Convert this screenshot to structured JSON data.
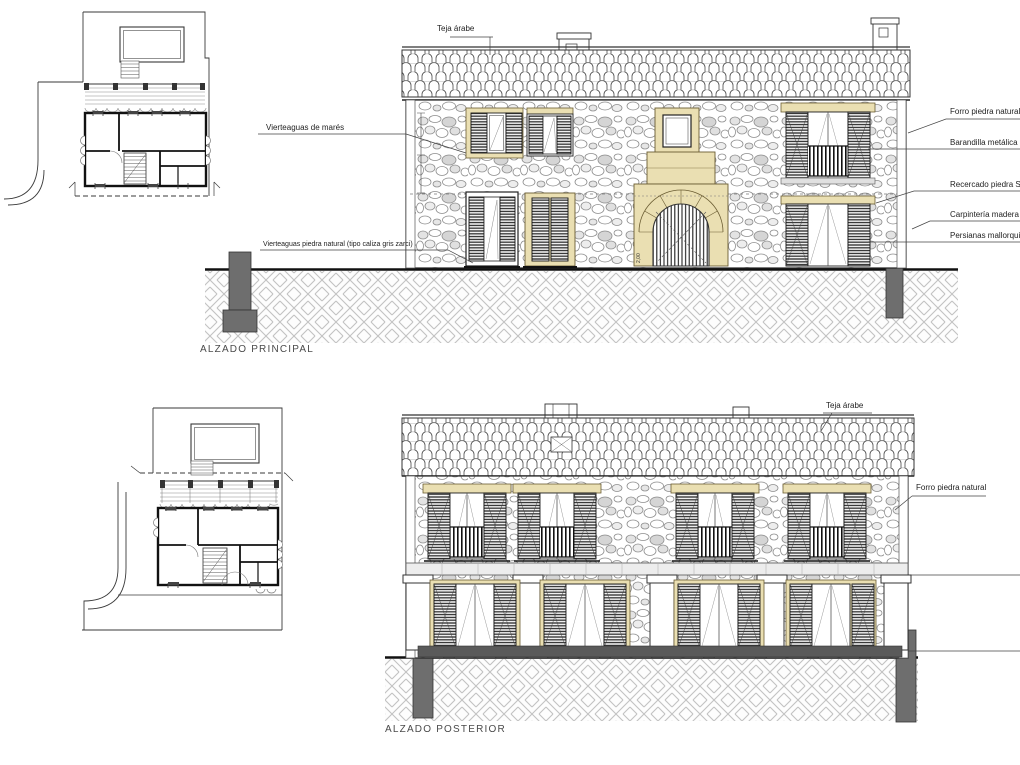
{
  "sheet": {
    "principal": {
      "title": "ALZADO PRINCIPAL",
      "labels": {
        "teja_arabe": "Teja árabe",
        "vierteaguas_mares": "Vierteaguas de marés",
        "vierteaguas_piedra": "Vierteaguas piedra natural (tipo caliza gris zarci)",
        "forro_piedra": "Forro piedra natural",
        "barandilla": "Barandilla metálica de ac",
        "recercado": "Recercado piedra Santa",
        "carpinteria": "Carpintería madera de ir",
        "persianas": "Persianas mallorquinas p",
        "arch_width_dim": "2,00"
      }
    },
    "posterior": {
      "title": "ALZADO POSTERIOR",
      "labels": {
        "teja_arabe": "Teja árabe",
        "forro_piedra": "Forro piedra natural"
      }
    },
    "colors": {
      "paper": "#ffffff",
      "ink": "#2f2f2f",
      "stone_trim": "#eadfb2",
      "masonry_gray": "#8d8d8d",
      "ground_hatch": "#c2c2c2",
      "pier_gray": "#6e6e6e"
    }
  }
}
